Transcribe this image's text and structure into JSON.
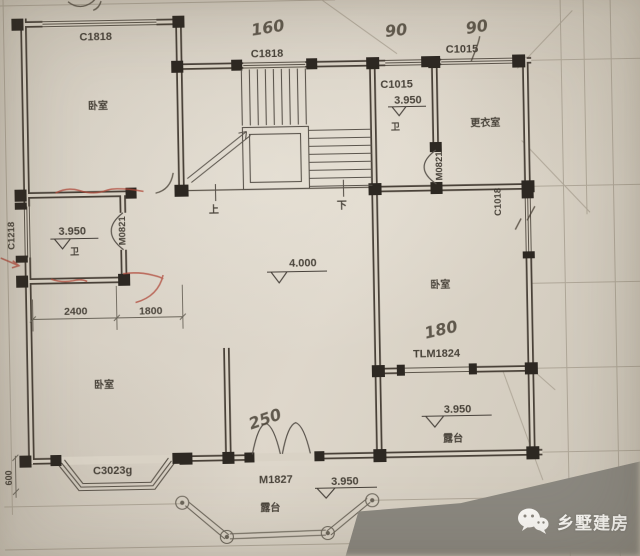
{
  "plan": {
    "rooms": {
      "bedroom": "卧室",
      "dressing": "更衣室",
      "bath": "卫",
      "terrace": "露台"
    },
    "stairs": {
      "up": "上",
      "down": "下"
    },
    "openings": {
      "c1818": "C1818",
      "c1015": "C1015",
      "c1218": "C1218",
      "c1018": "C1018",
      "c3023g": "C3023g",
      "m0821": "M0821",
      "m1827": "M1827",
      "tlm1824": "TLM1824"
    },
    "levels": {
      "hall": "4.000",
      "upper": "3.950"
    },
    "dims": {
      "w2400": "2400",
      "w1800": "1800",
      "d600": "600"
    },
    "pencil": {
      "n160": "160",
      "n90": "90",
      "n180": "180",
      "n250": "250"
    }
  },
  "watermark": {
    "brand": "乡墅建房"
  },
  "colors": {
    "paper": "#d8d1c5",
    "ink": "#494138",
    "pier": "#2d2822",
    "red_pen": "#b0493a",
    "table": "#8b8880",
    "watermark_text": "#fbfaf7"
  }
}
